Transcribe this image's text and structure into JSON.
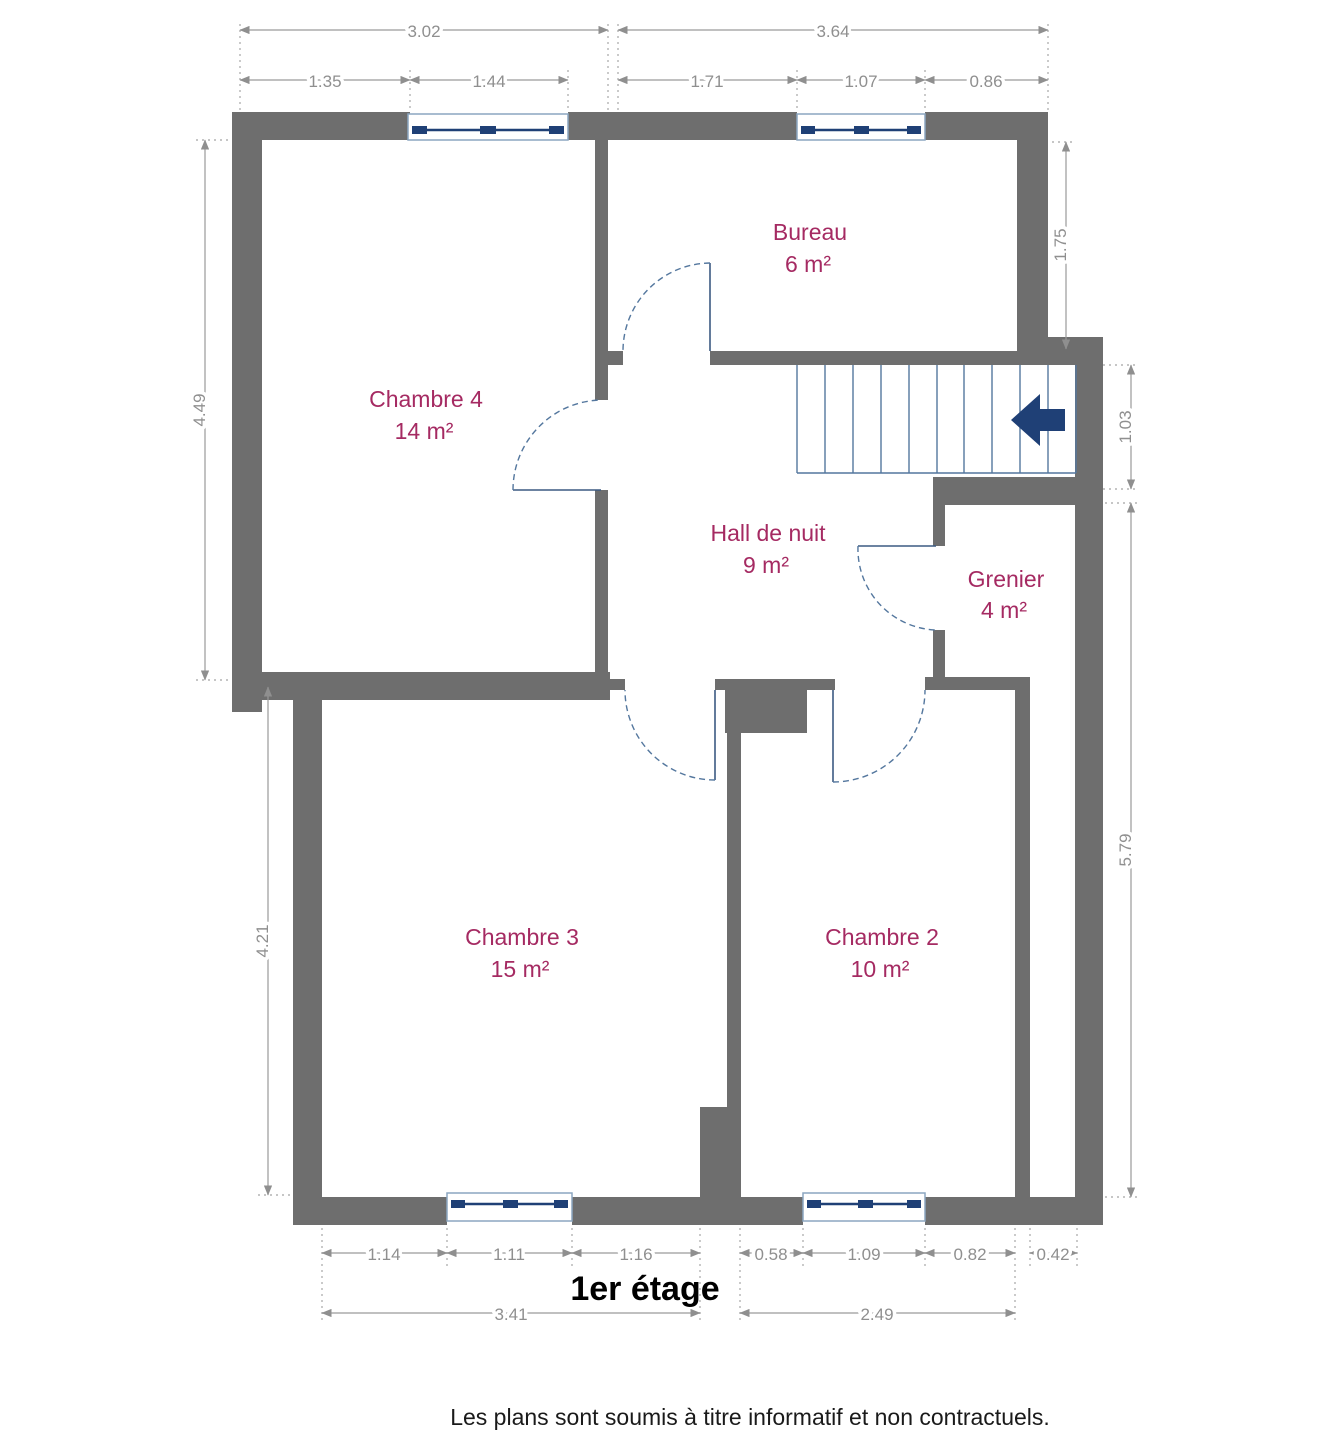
{
  "title": "1er étage",
  "footer": "Les plans sont soumis à titre informatif et non contractuels.",
  "colors": {
    "wall": "#6e6e6e",
    "room_label": "#a52a62",
    "dimension": "#8f8f8f",
    "stair_stroke": "#54779e",
    "navy_accent": "#1f4076",
    "title": "#000000"
  },
  "rooms": [
    {
      "id": "bureau",
      "name": "Bureau",
      "area": "6 m²"
    },
    {
      "id": "chambre4",
      "name": "Chambre 4",
      "area": "14 m²"
    },
    {
      "id": "hall",
      "name": "Hall de nuit",
      "area": "9 m²"
    },
    {
      "id": "grenier",
      "name": "Grenier",
      "area": "4 m²"
    },
    {
      "id": "chambre3",
      "name": "Chambre 3",
      "area": "15 m²"
    },
    {
      "id": "chambre2",
      "name": "Chambre 2",
      "area": "10 m²"
    }
  ],
  "dimensions": {
    "top_overall": [
      "3.02",
      "3.64"
    ],
    "top_detail": [
      "1.35",
      "1.44",
      "1.71",
      "1.07",
      "0.86"
    ],
    "left": [
      "4.49",
      "4.21"
    ],
    "right": [
      "1.75",
      "1.03",
      "5.79"
    ],
    "bottom_detail": [
      "1.14",
      "1.11",
      "1.16",
      "0.58",
      "1.09",
      "0.82",
      "0.42"
    ],
    "bottom_overall": [
      "3.41",
      "2.49"
    ]
  },
  "icons": {
    "stairs_direction": "arrow-left-icon"
  }
}
